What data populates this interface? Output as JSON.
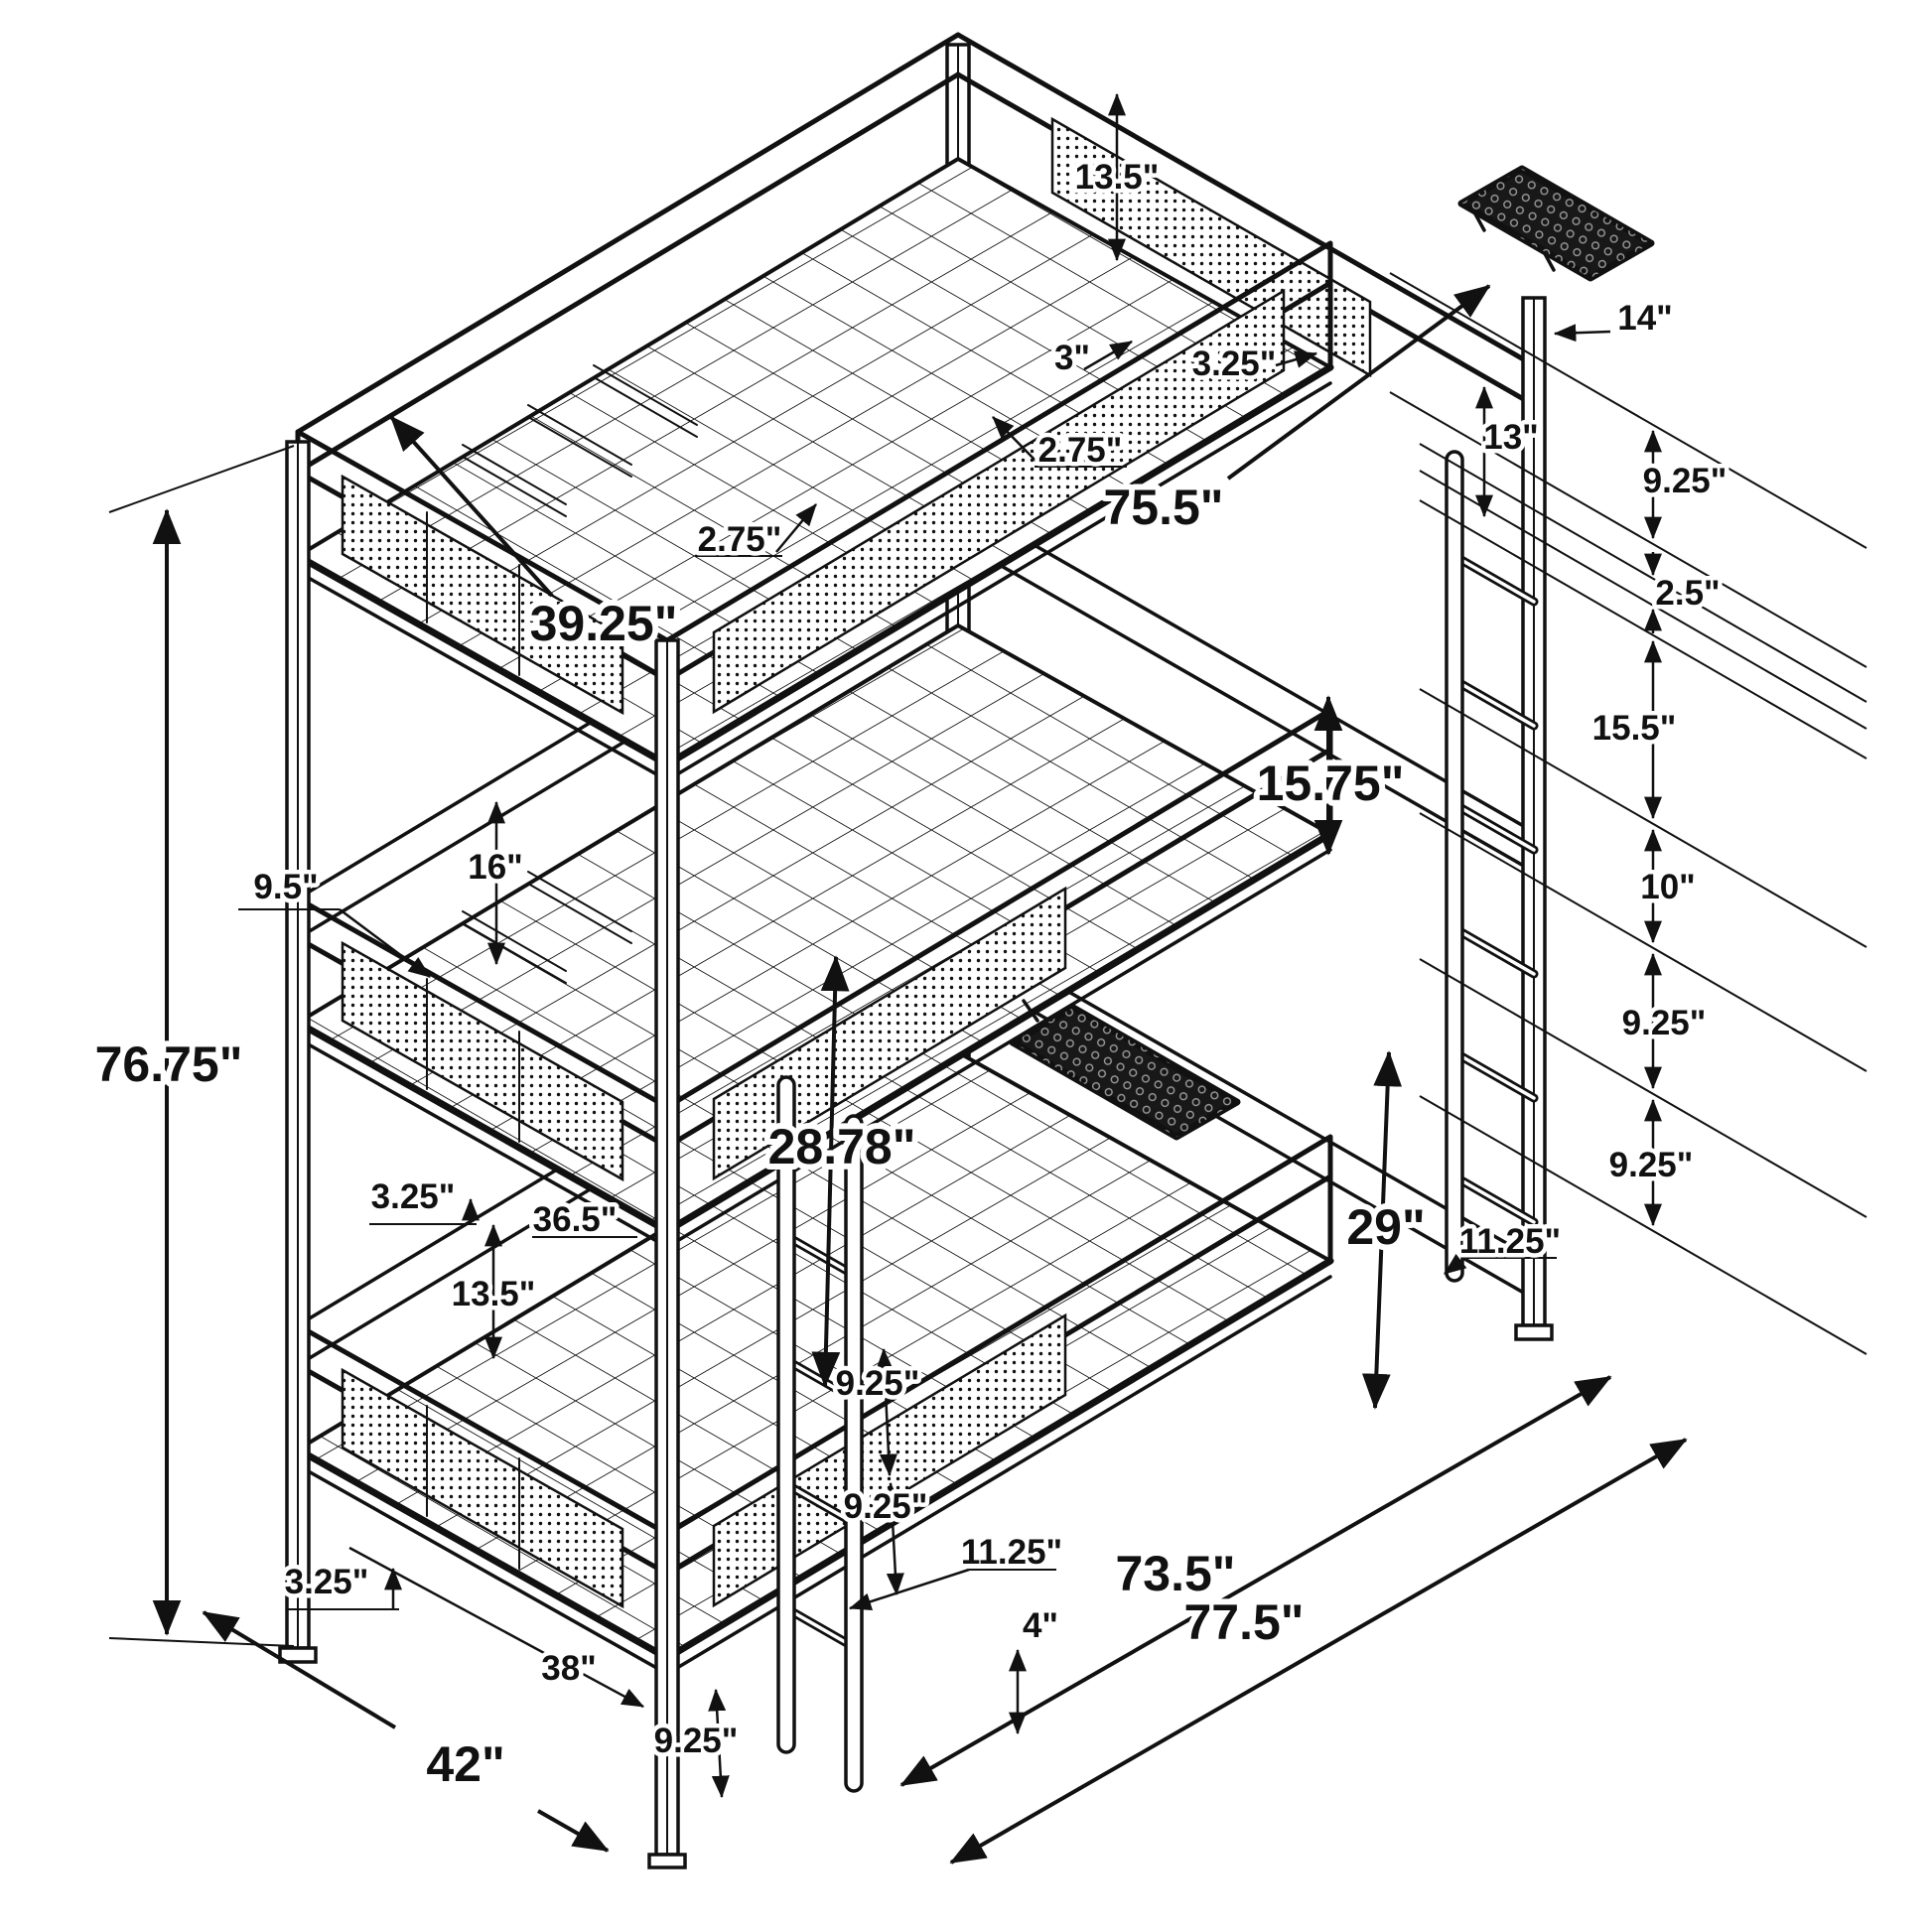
{
  "meta": {
    "drawing_type": "isometric technical dimension diagram",
    "subject": "3-tier metal triple bunk bed frame with wire decks, mesh guard rails, end ladder, front ladder and two clip-on mesh trays",
    "unit": "inches",
    "line_color": "#111111",
    "background_color": "#ffffff"
  },
  "dims": [
    {
      "id": "top-guardrail-height",
      "label": "13.5\""
    },
    {
      "id": "top-slat-gap-3",
      "label": "3\""
    },
    {
      "id": "top-slat-gap-3-25",
      "label": "3.25\""
    },
    {
      "id": "top-slat-width-a",
      "label": "2.75\""
    },
    {
      "id": "top-slat-width-b",
      "label": "2.75\""
    },
    {
      "id": "bunk-inner-length",
      "label": "75.5\""
    },
    {
      "id": "top-bunk-width",
      "label": "39.25\""
    },
    {
      "id": "end-post-offset-14",
      "label": "14\""
    },
    {
      "id": "end-rung-gap-13",
      "label": "13\""
    },
    {
      "id": "right-gap-9-25-a",
      "label": "9.25\""
    },
    {
      "id": "right-gap-2-5",
      "label": "2.5\""
    },
    {
      "id": "right-gap-15-5",
      "label": "15.5\""
    },
    {
      "id": "right-gap-10",
      "label": "10\""
    },
    {
      "id": "right-gap-9-25-b",
      "label": "9.25\""
    },
    {
      "id": "right-gap-9-25-c",
      "label": "9.25\""
    },
    {
      "id": "bunk-clearance-15-75",
      "label": "15.75\""
    },
    {
      "id": "left-gap-16",
      "label": "16\""
    },
    {
      "id": "left-rail-offset-9-5",
      "label": "9.5\""
    },
    {
      "id": "mid-clearance-28-78",
      "label": "28.78\""
    },
    {
      "id": "bottom-clearance-29",
      "label": "29\""
    },
    {
      "id": "left-offset-3-25",
      "label": "3.25\""
    },
    {
      "id": "mid-rail-length-36-5",
      "label": "36.5\""
    },
    {
      "id": "left-gap-13-5",
      "label": "13.5\""
    },
    {
      "id": "end-ladder-width-11-25",
      "label": "11.25\""
    },
    {
      "id": "front-rung-gap-9-25-a",
      "label": "9.25\""
    },
    {
      "id": "front-rung-gap-9-25-b",
      "label": "9.25\""
    },
    {
      "id": "front-rung-width-11-25",
      "label": "11.25\""
    },
    {
      "id": "front-rung-floor-gap-4",
      "label": "4\""
    },
    {
      "id": "bottom-offset-3-25",
      "label": "3.25\""
    },
    {
      "id": "bottom-width-38",
      "label": "38\""
    },
    {
      "id": "overall-width-42",
      "label": "42\""
    },
    {
      "id": "frame-length-73-5",
      "label": "73.5\""
    },
    {
      "id": "overall-length-77-5",
      "label": "77.5\""
    },
    {
      "id": "overall-height-76-75",
      "label": "76.75\""
    },
    {
      "id": "bottom-rung-gap-9-25",
      "label": "9.25\""
    }
  ]
}
